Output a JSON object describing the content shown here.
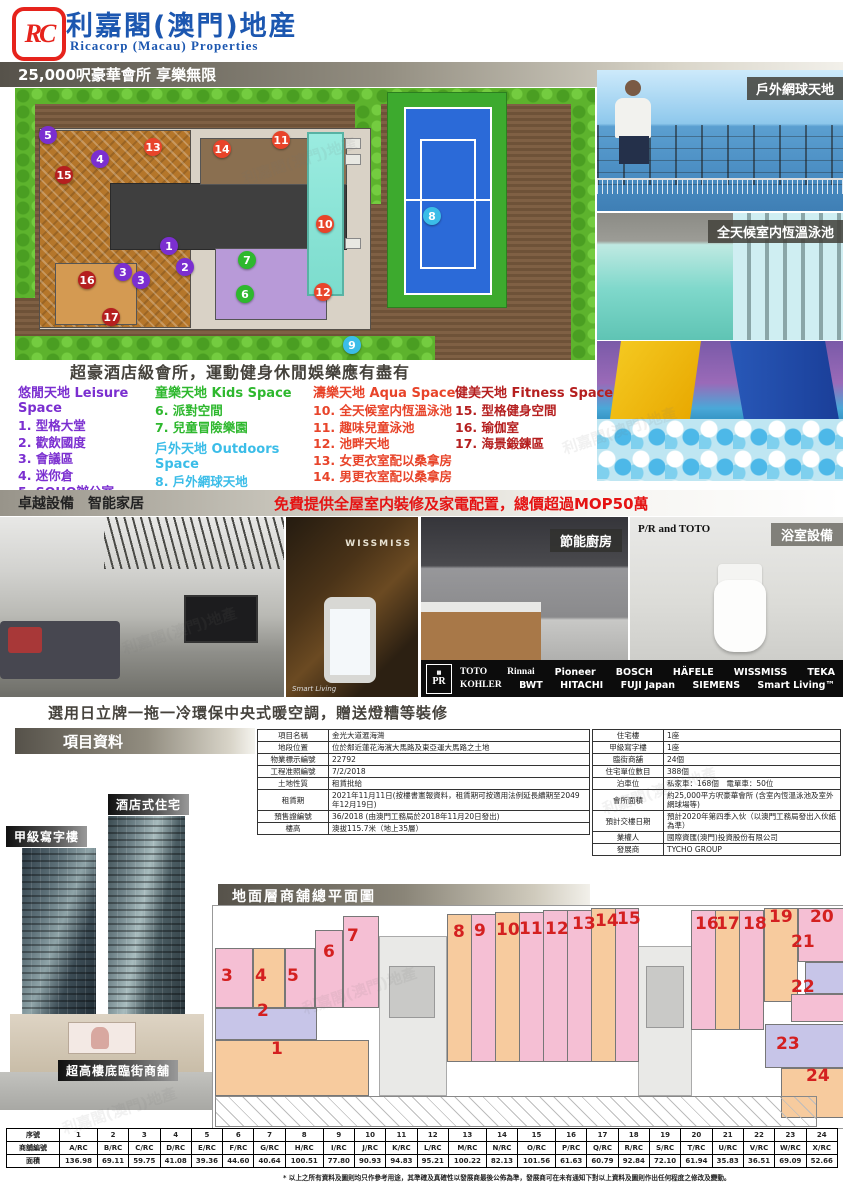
{
  "header": {
    "logo_letters": "RC",
    "brand_cn": "利嘉閣(澳門)地産",
    "brand_en": "Ricacorp (Macau) Properties"
  },
  "clubhouse": {
    "banner": "25,000呎豪華會所 享樂無限",
    "tagline": "超豪酒店級會所，運動健身休閒娛樂應有盡有",
    "photo_label_tennis": "戶外網球天地",
    "photo_label_pool": "全天候室内恆溫泳池",
    "category_colors": {
      "leisure": "#7b2fd0",
      "kids": "#2eb82e",
      "outdoors": "#3bbde8",
      "aqua": "#e8442a",
      "fitness": "#b51f1f"
    },
    "categories": [
      {
        "key": "leisure",
        "title": "悠閒天地 Leisure Space",
        "color": "#7b2fd0",
        "items": [
          "1. 型格大堂",
          "2. 歡飲國度",
          "3. 會議區",
          "4. 迷你倉",
          "5. SOHO辦公室"
        ]
      },
      {
        "key": "kids",
        "title": "童樂天地 Kids Space",
        "color": "#2eb82e",
        "items": [
          "6. 派對空間",
          "7. 兒童冒險樂園"
        ]
      },
      {
        "key": "outdoors",
        "title": "戶外天地 Outdoors Space",
        "color": "#3bbde8",
        "items": [
          "8. 戶外網球天地",
          "9. 自助燒烤區"
        ]
      },
      {
        "key": "aqua",
        "title": "濤樂天地 Aqua Space",
        "color": "#e8442a",
        "items": [
          "10. 全天候室内恆溫泳池",
          "11. 趣味兒童泳池",
          "12. 池畔天地",
          "13. 女更衣室配以桑拿房",
          "14. 男更衣室配以桑拿房"
        ]
      },
      {
        "key": "fitness",
        "title": "健美天地 Fitness Space",
        "color": "#b51f1f",
        "items": [
          "15. 型格健身空間",
          "16. 瑜伽室",
          "17. 海景鍛鍊區"
        ]
      }
    ],
    "markers": [
      {
        "n": "1",
        "cat": "leisure",
        "x": 169,
        "y": 246
      },
      {
        "n": "2",
        "cat": "leisure",
        "x": 185,
        "y": 267
      },
      {
        "n": "3",
        "cat": "leisure",
        "x": 123,
        "y": 272
      },
      {
        "n": "3",
        "cat": "leisure",
        "x": 141,
        "y": 280
      },
      {
        "n": "4",
        "cat": "leisure",
        "x": 100,
        "y": 159
      },
      {
        "n": "5",
        "cat": "leisure",
        "x": 48,
        "y": 135
      },
      {
        "n": "6",
        "cat": "kids",
        "x": 245,
        "y": 294
      },
      {
        "n": "7",
        "cat": "kids",
        "x": 247,
        "y": 260
      },
      {
        "n": "8",
        "cat": "outdoors",
        "x": 432,
        "y": 216
      },
      {
        "n": "9",
        "cat": "outdoors",
        "x": 352,
        "y": 345
      },
      {
        "n": "10",
        "cat": "aqua",
        "x": 325,
        "y": 224
      },
      {
        "n": "11",
        "cat": "aqua",
        "x": 281,
        "y": 140
      },
      {
        "n": "12",
        "cat": "aqua",
        "x": 323,
        "y": 292
      },
      {
        "n": "13",
        "cat": "aqua",
        "x": 153,
        "y": 147
      },
      {
        "n": "14",
        "cat": "aqua",
        "x": 222,
        "y": 149
      },
      {
        "n": "15",
        "cat": "fitness",
        "x": 64,
        "y": 175
      },
      {
        "n": "16",
        "cat": "fitness",
        "x": 87,
        "y": 280
      },
      {
        "n": "17",
        "cat": "fitness",
        "x": 111,
        "y": 317
      }
    ]
  },
  "equipment": {
    "bar_title": "卓越設備　智能家居",
    "highlight": "免費提供全屋室内裝修及家電配置，總價超過MOP50萬",
    "wissmiss_text": "WISSMISS",
    "smartliving_caption": "Smart Living",
    "kitchen_label": "節能廚房",
    "bath_brand": "P/R and TOTO",
    "bath_label": "浴室設備",
    "pr_emblem": "PR",
    "brands_row1": [
      "TOTO",
      "Rinnai",
      "Pioneer",
      "BOSCH",
      "HÄFELE",
      "WISSMISS",
      "TEKA"
    ],
    "brands_row2": [
      "KOHLER",
      "BWT",
      "HITACHI",
      "FUJI Japan",
      "SIEMENS",
      "Smart Living™"
    ],
    "note": "選用日立牌一拖一冷環保中央式暖空調，贈送燈糟等裝修"
  },
  "project": {
    "bar_title": "項目資料",
    "left_table": [
      {
        "label": "項目名稱",
        "value": "金光大道滙海灣"
      },
      {
        "label": "地段位置",
        "value": "位於鄰近蓮花海濱大馬路及東亞運大馬路之土地"
      },
      {
        "label": "物業標示編號",
        "value": "22792"
      },
      {
        "label": "工程准照編號",
        "value": "7/2/2018"
      },
      {
        "label": "土地性質",
        "value": "租賃批給"
      },
      {
        "label": "租賃期",
        "value": "2021年11月11日(按樓書憲報資料，租賃期可按適用法例延長續期至2049年12月19日)"
      },
      {
        "label": "預售證編號",
        "value": "36/2018 (由澳門工務局於2018年11月20日發出)"
      },
      {
        "label": "樓高",
        "value": "澳拔115.7米（地上35層）"
      }
    ],
    "right_table": [
      {
        "label": "住宅樓",
        "value": "1座"
      },
      {
        "label": "甲級寫字樓",
        "value": "1座"
      },
      {
        "label": "臨街商舖",
        "value": "24個"
      },
      {
        "label": "住宅單位數目",
        "value": "388個"
      },
      {
        "label": "泊車位",
        "value": "私家車：168個　電單車：50位"
      },
      {
        "label": "會所面積",
        "value": "約25,000平方呎豪華會所 (含室內恆溫泳池及室外網球場等)"
      },
      {
        "label": "預計交樓日期",
        "value": "預計2020年第四季入伙（以澳門工務局發出入伙紙為準）"
      },
      {
        "label": "業權人",
        "value": "國際資匯(澳門)投資股份有限公司"
      },
      {
        "label": "發展商",
        "value": "TYCHO GROUP"
      }
    ]
  },
  "buildings": {
    "label_residence": "酒店式住宅",
    "label_office": "甲級寫字樓",
    "label_shops": "超高樓底臨街商舖"
  },
  "shopplan": {
    "title": "地面層商舖總平面圖",
    "shop_colors": {
      "pink": "#f5bfd4",
      "peach": "#f7cb9e",
      "lavender": "#c7c5e8"
    },
    "numbers": [
      {
        "n": "1",
        "x": 58,
        "y": 135
      },
      {
        "n": "2",
        "x": 44,
        "y": 97
      },
      {
        "n": "3",
        "x": 8,
        "y": 62
      },
      {
        "n": "4",
        "x": 42,
        "y": 62
      },
      {
        "n": "5",
        "x": 74,
        "y": 62
      },
      {
        "n": "6",
        "x": 110,
        "y": 38
      },
      {
        "n": "7",
        "x": 134,
        "y": 22
      },
      {
        "n": "8",
        "x": 240,
        "y": 18
      },
      {
        "n": "9",
        "x": 261,
        "y": 17
      },
      {
        "n": "10",
        "x": 283,
        "y": 16
      },
      {
        "n": "11",
        "x": 306,
        "y": 15
      },
      {
        "n": "12",
        "x": 332,
        "y": 15
      },
      {
        "n": "13",
        "x": 359,
        "y": 10
      },
      {
        "n": "14",
        "x": 382,
        "y": 7
      },
      {
        "n": "15",
        "x": 404,
        "y": 5
      },
      {
        "n": "16",
        "x": 482,
        "y": 10
      },
      {
        "n": "17",
        "x": 503,
        "y": 10
      },
      {
        "n": "18",
        "x": 530,
        "y": 10
      },
      {
        "n": "19",
        "x": 556,
        "y": 3
      },
      {
        "n": "20",
        "x": 597,
        "y": 3
      },
      {
        "n": "21",
        "x": 578,
        "y": 28
      },
      {
        "n": "22",
        "x": 578,
        "y": 73
      },
      {
        "n": "23",
        "x": 563,
        "y": 130
      },
      {
        "n": "24",
        "x": 593,
        "y": 162
      }
    ]
  },
  "area_table": {
    "row_headers": [
      "序號",
      "商舖編號",
      "面積"
    ],
    "nums": [
      "1",
      "2",
      "3",
      "4",
      "5",
      "6",
      "7",
      "8",
      "9",
      "10",
      "11",
      "12",
      "13",
      "14",
      "15",
      "16",
      "17",
      "18",
      "19",
      "20",
      "21",
      "22",
      "23",
      "24"
    ],
    "codes": [
      "A/RC",
      "B/RC",
      "C/RC",
      "D/RC",
      "E/RC",
      "F/RC",
      "G/RC",
      "H/RC",
      "I/RC",
      "J/RC",
      "K/RC",
      "L/RC",
      "M/RC",
      "N/RC",
      "O/RC",
      "P/RC",
      "Q/RC",
      "R/RC",
      "S/RC",
      "T/RC",
      "U/RC",
      "V/RC",
      "W/RC",
      "X/RC"
    ],
    "areas": [
      "136.98",
      "69.11",
      "59.75",
      "41.08",
      "39.36",
      "44.60",
      "40.64",
      "100.51",
      "77.80",
      "90.93",
      "94.83",
      "95.21",
      "100.22",
      "82.13",
      "101.56",
      "61.63",
      "60.79",
      "92.84",
      "72.10",
      "61.94",
      "35.83",
      "36.51",
      "69.09",
      "52.66"
    ]
  },
  "footer": "* 以上之所有資料及圖則均只作參考用途，其準確及真確性以發展商最後公佈為準，發展商可在未有通知下對以上資料及圖則作出任何程度之修改及變動。"
}
